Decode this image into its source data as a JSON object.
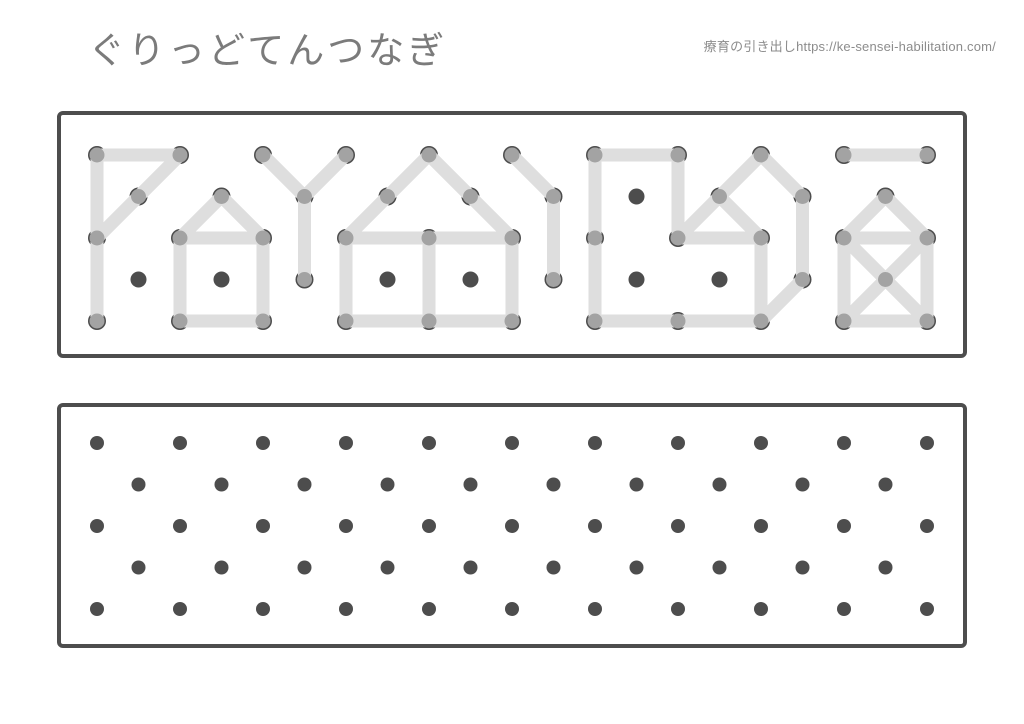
{
  "header": {
    "title": "ぐりっどてんつなぎ",
    "credit": "療育の引き出しhttps://ke-sensei-habilitation.com/"
  },
  "colors": {
    "page_bg": "#ffffff",
    "title_text": "#7b7b7b",
    "credit_text": "#8c8c8c",
    "panel_border": "#4d4d4d",
    "panel_fill": "#ffffff",
    "dot_inactive": "#4d4d4d",
    "dot_active": "#a3a3a3",
    "dot_base_ring": "#4d4d4d",
    "line": "#dedede"
  },
  "grid": {
    "col_spacing": 83,
    "row_spacing": 41.5,
    "odd_row_offset": 41.5,
    "rows": 5,
    "cols_even_rows": 11,
    "cols_odd_rows": 10
  },
  "sample_panel": {
    "role": "sample patterns to copy",
    "frame": {
      "width": 910,
      "height": 247,
      "border_width": 4,
      "corner_radius": 4
    },
    "grid_origin": {
      "x": 40,
      "y": 44
    },
    "line_width": 13,
    "dot_radius_base": 9,
    "dot_radius_active": 7.5,
    "dot_radius_inactive": 8,
    "inactive_dots": [
      [
        1,
        6
      ],
      [
        3,
        0
      ],
      [
        3,
        1
      ],
      [
        3,
        3
      ],
      [
        3,
        4
      ],
      [
        3,
        6
      ],
      [
        3,
        7
      ]
    ],
    "shapes": [
      {
        "name": "flag-triangle-with-stem",
        "segments": [
          [
            [
              0,
              0
            ],
            [
              0,
              1
            ]
          ],
          [
            [
              0,
              1
            ],
            [
              1,
              0
            ]
          ],
          [
            [
              1,
              0
            ],
            [
              2,
              0
            ]
          ],
          [
            [
              0,
              0
            ],
            [
              2,
              0
            ]
          ],
          [
            [
              2,
              0
            ],
            [
              4,
              0
            ]
          ]
        ]
      },
      {
        "name": "small-house",
        "segments": [
          [
            [
              1,
              1
            ],
            [
              2,
              1
            ]
          ],
          [
            [
              1,
              1
            ],
            [
              2,
              2
            ]
          ],
          [
            [
              2,
              1
            ],
            [
              2,
              2
            ]
          ],
          [
            [
              2,
              1
            ],
            [
              4,
              1
            ]
          ],
          [
            [
              2,
              2
            ],
            [
              4,
              2
            ]
          ],
          [
            [
              4,
              1
            ],
            [
              4,
              2
            ]
          ]
        ]
      },
      {
        "name": "y-shape",
        "segments": [
          [
            [
              0,
              2
            ],
            [
              1,
              2
            ]
          ],
          [
            [
              0,
              3
            ],
            [
              1,
              2
            ]
          ],
          [
            [
              1,
              2
            ],
            [
              3,
              2
            ]
          ]
        ]
      },
      {
        "name": "big-house-two-rooms",
        "segments": [
          [
            [
              0,
              4
            ],
            [
              1,
              3
            ]
          ],
          [
            [
              1,
              3
            ],
            [
              2,
              3
            ]
          ],
          [
            [
              0,
              4
            ],
            [
              1,
              4
            ]
          ],
          [
            [
              1,
              4
            ],
            [
              2,
              5
            ]
          ],
          [
            [
              2,
              3
            ],
            [
              2,
              4
            ]
          ],
          [
            [
              2,
              4
            ],
            [
              2,
              5
            ]
          ],
          [
            [
              2,
              3
            ],
            [
              4,
              3
            ]
          ],
          [
            [
              2,
              4
            ],
            [
              4,
              4
            ]
          ],
          [
            [
              2,
              5
            ],
            [
              4,
              5
            ]
          ],
          [
            [
              4,
              3
            ],
            [
              4,
              4
            ]
          ],
          [
            [
              4,
              4
            ],
            [
              4,
              5
            ]
          ]
        ]
      },
      {
        "name": "bent-line",
        "segments": [
          [
            [
              0,
              5
            ],
            [
              1,
              5
            ]
          ],
          [
            [
              1,
              5
            ],
            [
              3,
              5
            ]
          ]
        ]
      },
      {
        "name": "l-block-with-cube",
        "segments": [
          [
            [
              0,
              6
            ],
            [
              0,
              7
            ]
          ],
          [
            [
              0,
              6
            ],
            [
              2,
              6
            ]
          ],
          [
            [
              2,
              6
            ],
            [
              4,
              6
            ]
          ],
          [
            [
              4,
              6
            ],
            [
              4,
              7
            ]
          ],
          [
            [
              4,
              7
            ],
            [
              4,
              8
            ]
          ],
          [
            [
              0,
              7
            ],
            [
              2,
              7
            ]
          ],
          [
            [
              2,
              7
            ],
            [
              1,
              7
            ]
          ],
          [
            [
              1,
              7
            ],
            [
              0,
              8
            ]
          ],
          [
            [
              2,
              7
            ],
            [
              2,
              8
            ]
          ],
          [
            [
              1,
              7
            ],
            [
              2,
              8
            ]
          ],
          [
            [
              0,
              8
            ],
            [
              1,
              8
            ]
          ],
          [
            [
              1,
              8
            ],
            [
              3,
              8
            ]
          ],
          [
            [
              2,
              8
            ],
            [
              4,
              8
            ]
          ],
          [
            [
              3,
              8
            ],
            [
              4,
              8
            ]
          ]
        ]
      },
      {
        "name": "dash",
        "segments": [
          [
            [
              0,
              9
            ],
            [
              0,
              10
            ]
          ]
        ]
      },
      {
        "name": "envelope-with-roof",
        "segments": [
          [
            [
              1,
              9
            ],
            [
              2,
              9
            ]
          ],
          [
            [
              1,
              9
            ],
            [
              2,
              10
            ]
          ],
          [
            [
              2,
              9
            ],
            [
              2,
              10
            ]
          ],
          [
            [
              2,
              9
            ],
            [
              4,
              9
            ]
          ],
          [
            [
              2,
              10
            ],
            [
              4,
              10
            ]
          ],
          [
            [
              4,
              9
            ],
            [
              4,
              10
            ]
          ],
          [
            [
              2,
              9
            ],
            [
              3,
              9
            ]
          ],
          [
            [
              3,
              9
            ],
            [
              4,
              10
            ]
          ],
          [
            [
              2,
              10
            ],
            [
              3,
              9
            ]
          ],
          [
            [
              3,
              9
            ],
            [
              4,
              9
            ]
          ]
        ]
      }
    ]
  },
  "practice_panel": {
    "role": "empty practice grid",
    "frame": {
      "width": 910,
      "height": 245,
      "border_width": 4,
      "corner_radius": 4
    },
    "grid_origin": {
      "x": 40,
      "y": 40
    },
    "dot_radius": 7
  }
}
